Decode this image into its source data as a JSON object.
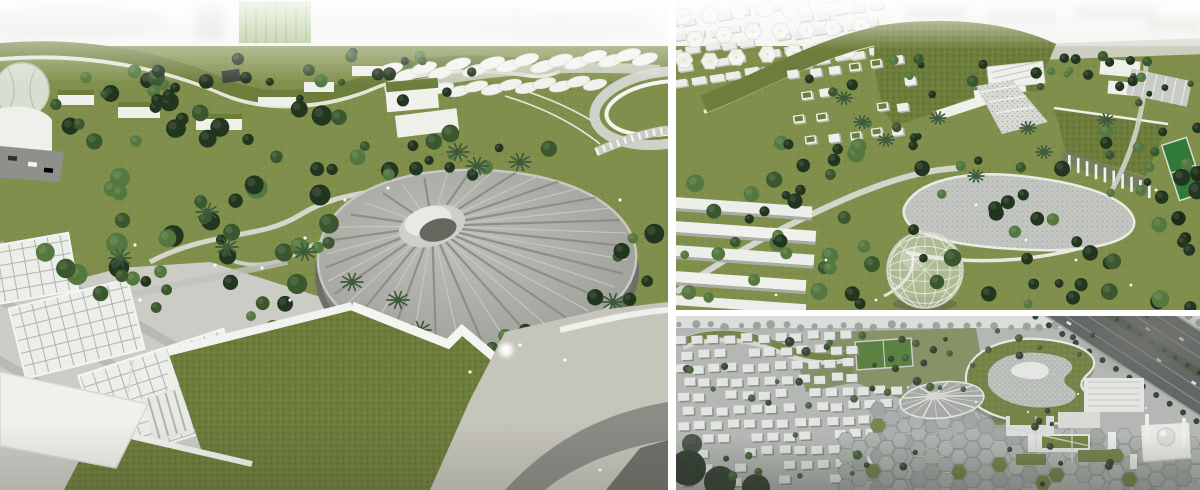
{
  "collage": {
    "kind": "architectural model photo collage",
    "divider_color": "#ffffff"
  },
  "panels": {
    "left": {
      "name": "model-photo-main",
      "description": "Aerial photograph of an architectural scale model: landscaped campus with green-roofed buildings, a radial-ribbed oval arena, white lattice pavilions, palm trees, winding paths and paved plazas under a bright washed-out backdrop"
    },
    "top_right": {
      "name": "model-photo-detail",
      "description": "Aerial photograph of the model detail: a winding green-roof building over cascading terraces, a cobbled pond, a transparent geodesic dome, scattered white villas, hexagonal shade canopies and tree-lined roads"
    },
    "bottom_right": {
      "name": "masterplan-rendering",
      "description": "Grayscale aerial rendering: dense white villa grid, hexagonal paved plaza, figure-eight green-roof building with pool courtyard, green sports field, domed mosque with minarets and a palm-lined highway"
    }
  },
  "palette": {
    "backdrop": "#f5f5f2",
    "lawn": "#80904c",
    "moss": "#6d7d3b",
    "forest_dark": "#22351e",
    "forest_mid": "#3a572e",
    "forest_light": "#547840",
    "palm": "#3d5a3b",
    "white_structure": "#f1f2ee",
    "concrete": "#a6a6a1",
    "concrete_dark": "#77776f",
    "paving": "#cbccc5",
    "paving_band": "#b3b6ae",
    "glass_green": "#8fb069",
    "pond": "#c3c6c1",
    "render_base": "#b3b7b3",
    "hex_tile": "#a9aeab",
    "hex_gap": "#848a85",
    "asphalt": "#575c59",
    "court_green": "#2f7a38",
    "dome_glass": "#e0e5dc",
    "light_dot": "#ffffff"
  }
}
